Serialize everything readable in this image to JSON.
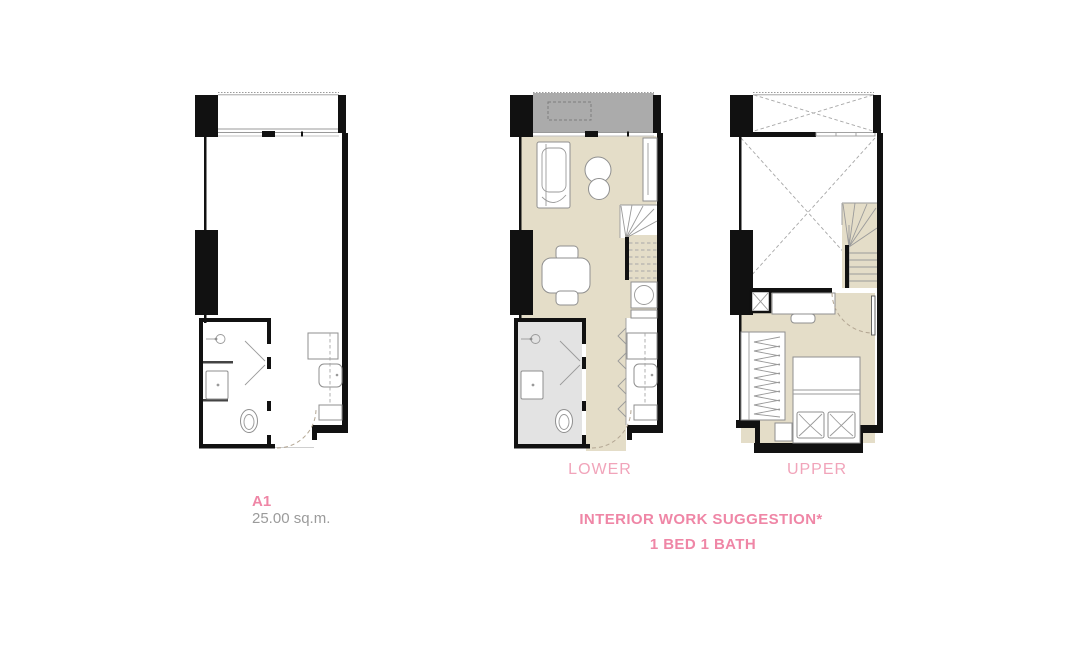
{
  "plans": {
    "unit": {
      "code": "A1",
      "area": "25.00 sq.m."
    },
    "lower": {
      "label": "LOWER"
    },
    "upper": {
      "label": "UPPER"
    }
  },
  "footer": {
    "line1": "INTERIOR WORK SUGGESTION*",
    "line2": "1 BED 1 BATH"
  },
  "colors": {
    "pink_bold": "#ef86a6",
    "pink_light": "#f1a4ba",
    "gray_text": "#9b9b9b",
    "floor_tan": "#e4ddc8",
    "balcony_gray": "#ababab",
    "bath_gray": "#e3e3e3",
    "wall_black": "#111111"
  }
}
